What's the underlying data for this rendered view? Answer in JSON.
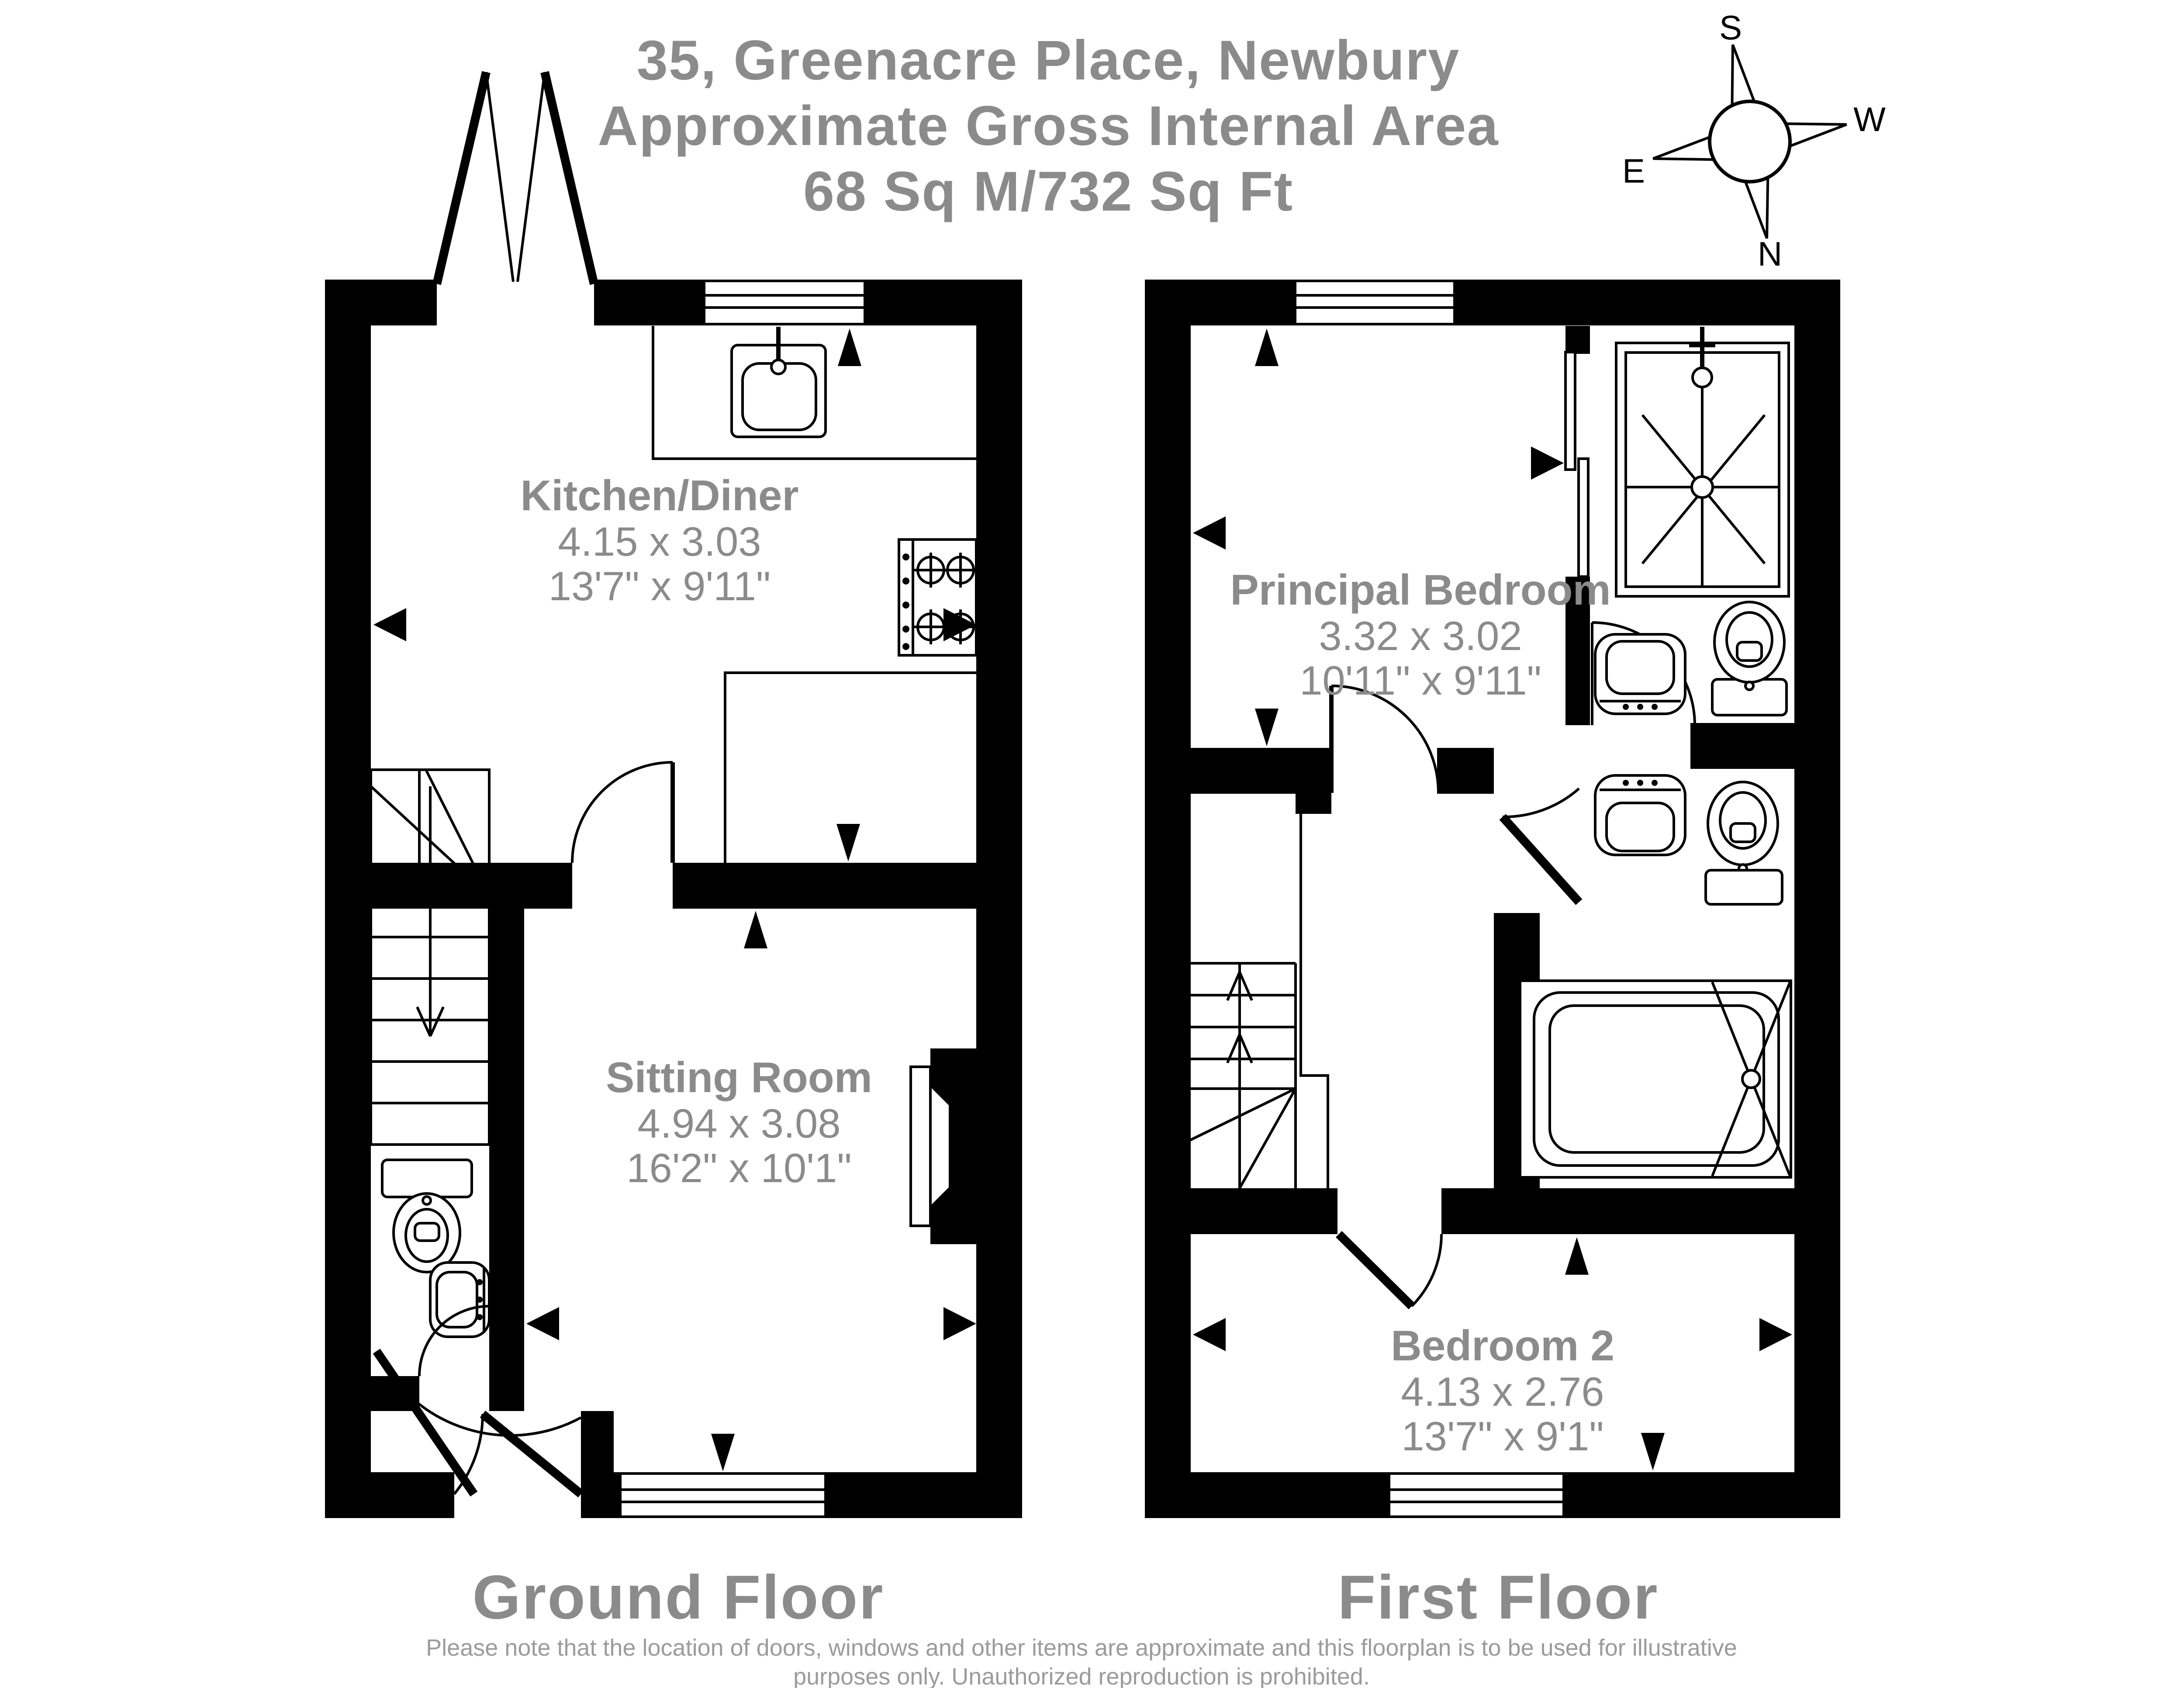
{
  "title": {
    "line1": "35, Greenacre Place, Newbury",
    "line2": "Approximate Gross Internal Area",
    "line3": "68 Sq M/732 Sq Ft"
  },
  "compass": {
    "north": "N",
    "south": "S",
    "east": "E",
    "west": "W"
  },
  "floors": [
    {
      "label": "Ground Floor",
      "rooms": [
        {
          "name": "Kitchen/Diner",
          "metric": "4.15 x 3.03",
          "imperial": "13'7\" x 9'11\""
        },
        {
          "name": "Sitting Room",
          "metric": "4.94 x 3.08",
          "imperial": "16'2\" x 10'1\""
        }
      ]
    },
    {
      "label": "First Floor",
      "rooms": [
        {
          "name": "Principal Bedroom",
          "metric": "3.32 x 3.02",
          "imperial": "10'11\" x 9'11\""
        },
        {
          "name": "Bedroom 2",
          "metric": "4.13 x 2.76",
          "imperial": "13'7\" x 9'1\""
        }
      ]
    }
  ],
  "disclaimer": {
    "line1": "Please note that the location of doors, windows and other items are approximate and this floorplan is to be used for illustrative",
    "line2": "purposes only. Unauthorized reproduction is prohibited."
  },
  "colors": {
    "wall": "#000000",
    "label_gray": "#8b8b8b",
    "disclaimer_gray": "#9b9b9b",
    "background": "#ffffff"
  }
}
